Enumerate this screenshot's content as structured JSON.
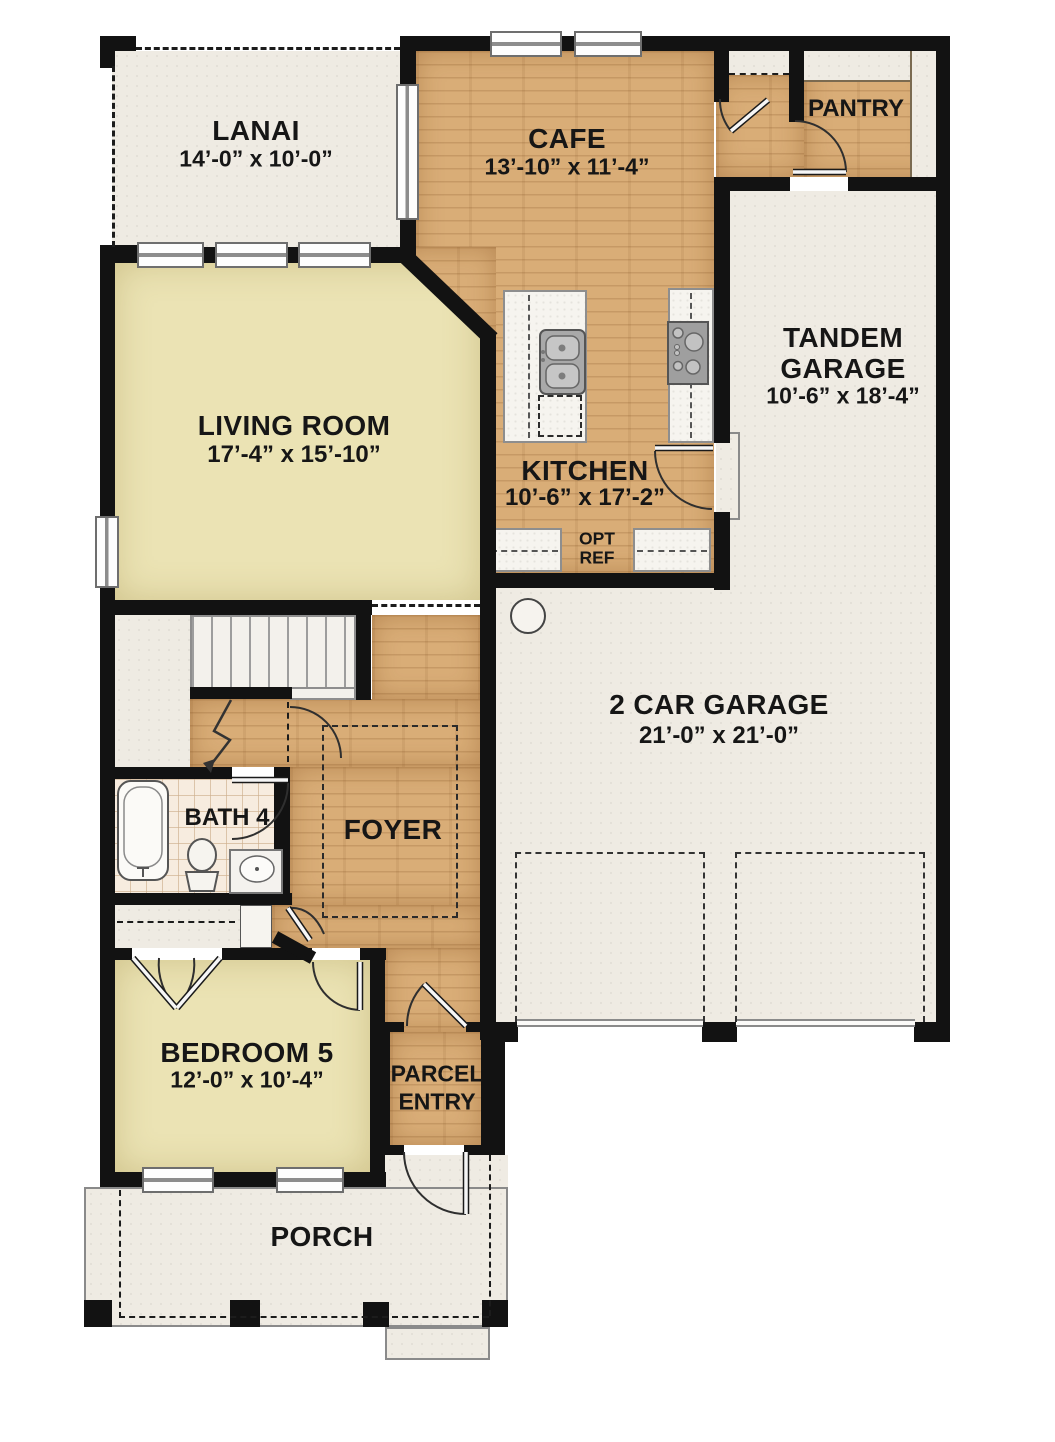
{
  "plan": {
    "colors": {
      "wall": "#121212",
      "wood_floor": "#d9ad77",
      "carpet_floor": "#ebe3b4",
      "concrete_floor": "#efebe3",
      "tile_floor": "#f7ecdf"
    },
    "rooms": {
      "lanai": {
        "name": "LANAI",
        "dims": "14’-0” x 10’-0”"
      },
      "cafe": {
        "name": "CAFE",
        "dims": "13’-10” x 11’-4”"
      },
      "pantry": {
        "name": "PANTRY"
      },
      "tandem_garage": {
        "name_line1": "TANDEM",
        "name_line2": "GARAGE",
        "dims": "10’-6” x 18’-4”"
      },
      "living_room": {
        "name": "LIVING ROOM",
        "dims": "17’-4” x 15’-10”"
      },
      "kitchen": {
        "name": "KITCHEN",
        "dims": "10’-6” x 17’-2”"
      },
      "two_car_garage": {
        "name": "2 CAR GARAGE",
        "dims": "21’-0” x 21’-0”"
      },
      "bath_4": {
        "name": "BATH 4"
      },
      "foyer": {
        "name": "FOYER"
      },
      "bedroom_5": {
        "name": "BEDROOM 5",
        "dims": "12’-0” x 10’-4”"
      },
      "parcel_entry": {
        "name_line1": "PARCEL",
        "name_line2": "ENTRY"
      },
      "porch": {
        "name": "PORCH"
      }
    },
    "annotations": {
      "opt_ref_line1": "OPT",
      "opt_ref_line2": "REF"
    }
  }
}
